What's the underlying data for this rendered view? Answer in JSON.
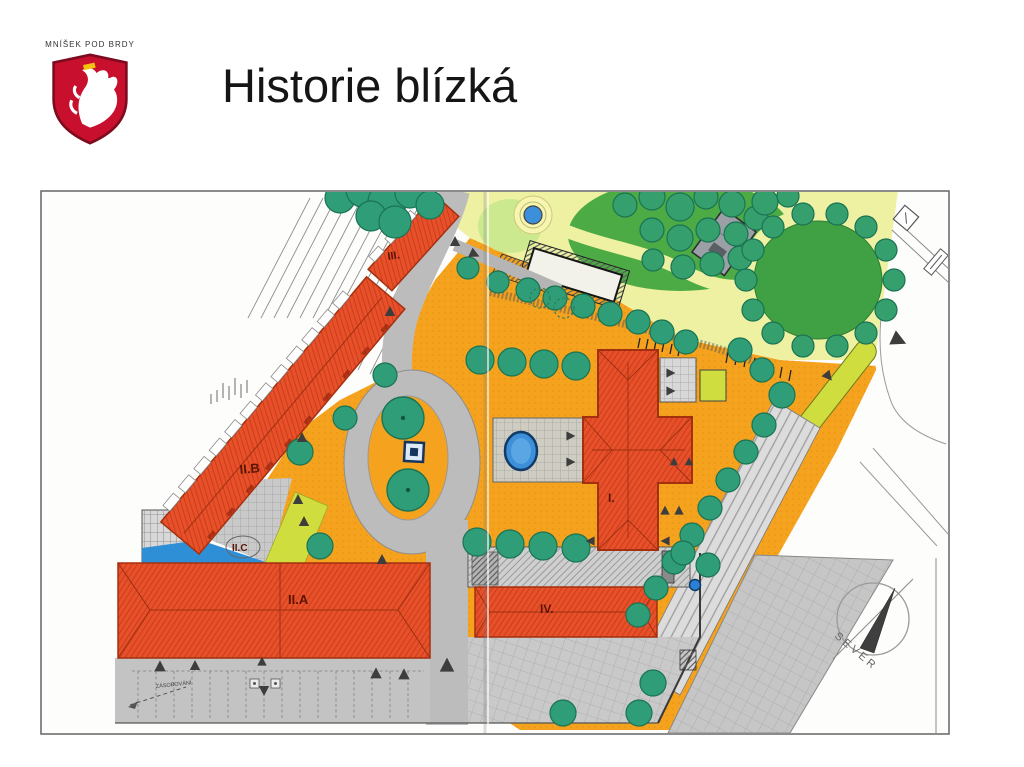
{
  "slide": {
    "logo_text": "MNÍŠEK POD BRDY",
    "title": "Historie blízká"
  },
  "plan_labels": {
    "b1": "I.",
    "b2a": "II.A",
    "b2b": "II.B",
    "b2c": "II.C",
    "b3": "III.",
    "b4": "IV."
  },
  "compass": {
    "north_label": "SEVER"
  },
  "annotations": {
    "loading_label": "ZÁSOBOVÁNÍ"
  },
  "colors": {
    "shield_red": "#c8102e",
    "building_red": "#e8502a",
    "plaza_orange": "#f5a31e",
    "lawn_green": "#46a247",
    "tree_teal": "#2f9e78",
    "chartreuse": "#cfdd3e",
    "water_blue": "#3c8fd8",
    "road_gray": "#bcbcbc"
  }
}
